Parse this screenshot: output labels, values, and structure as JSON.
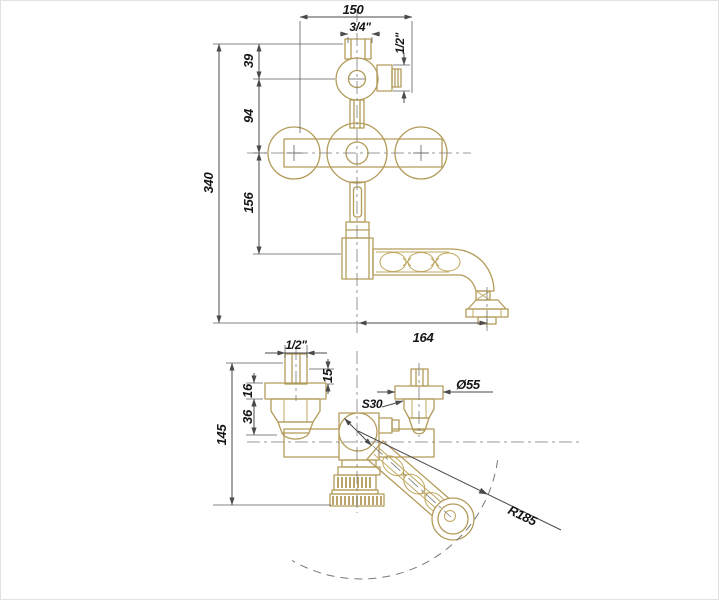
{
  "drawing": {
    "front_view": {
      "dim_width": "150",
      "thread_top": "3/4\"",
      "thread_shower": "1/2\"",
      "dim_39": "39",
      "dim_94": "94",
      "dim_156": "156",
      "dim_total_height": "340",
      "dim_spout_reach": "164"
    },
    "plan_view": {
      "thread_inlet": "1/2\"",
      "dim_15": "15",
      "dim_16": "16",
      "dim_36": "36",
      "dim_height": "145",
      "dim_escutcheon": "Ø55",
      "dim_wrench": "S30",
      "dim_swivel_radius": "R185"
    },
    "colors": {
      "body_outline": "#b39b5a",
      "dimension_lines": "#4a4a4a"
    }
  }
}
